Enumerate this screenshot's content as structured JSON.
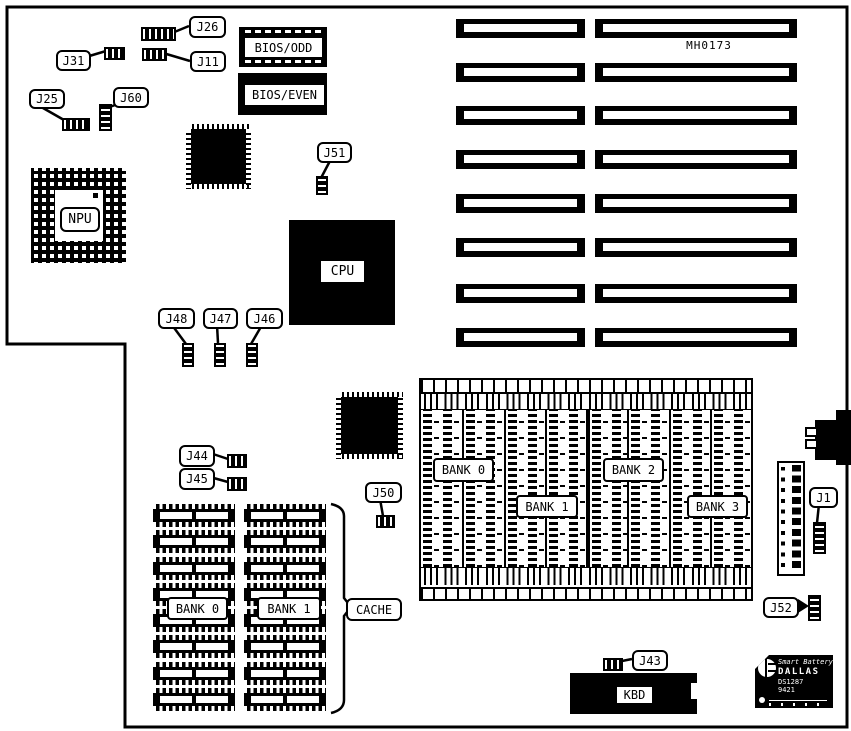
{
  "diagram": {
    "part_number": "MH0173"
  },
  "jumpers": {
    "j26": "J26",
    "j31": "J31",
    "j11": "J11",
    "j25": "J25",
    "j60": "J60",
    "j51": "J51",
    "j48": "J48",
    "j47": "J47",
    "j46": "J46",
    "j44": "J44",
    "j45": "J45",
    "j50": "J50",
    "j1": "J1",
    "j52": "J52",
    "j43": "J43"
  },
  "chips": {
    "npu": "NPU",
    "cpu": "CPU",
    "bios_odd": "BIOS/ODD",
    "bios_even": "BIOS/EVEN",
    "kbd": "KBD"
  },
  "memory": {
    "simm_bank_labels": [
      "BANK 0",
      "BANK 1",
      "BANK 2",
      "BANK 3"
    ],
    "cache_bank_labels": [
      "BANK 0",
      "BANK 1"
    ],
    "cache_label": "CACHE"
  },
  "battery": {
    "brand_script": "Smart Battery",
    "brand": "DALLAS",
    "model": "DS1287",
    "date_code": "9421"
  },
  "colors": {
    "ink": "#000000",
    "paper": "#ffffff"
  }
}
